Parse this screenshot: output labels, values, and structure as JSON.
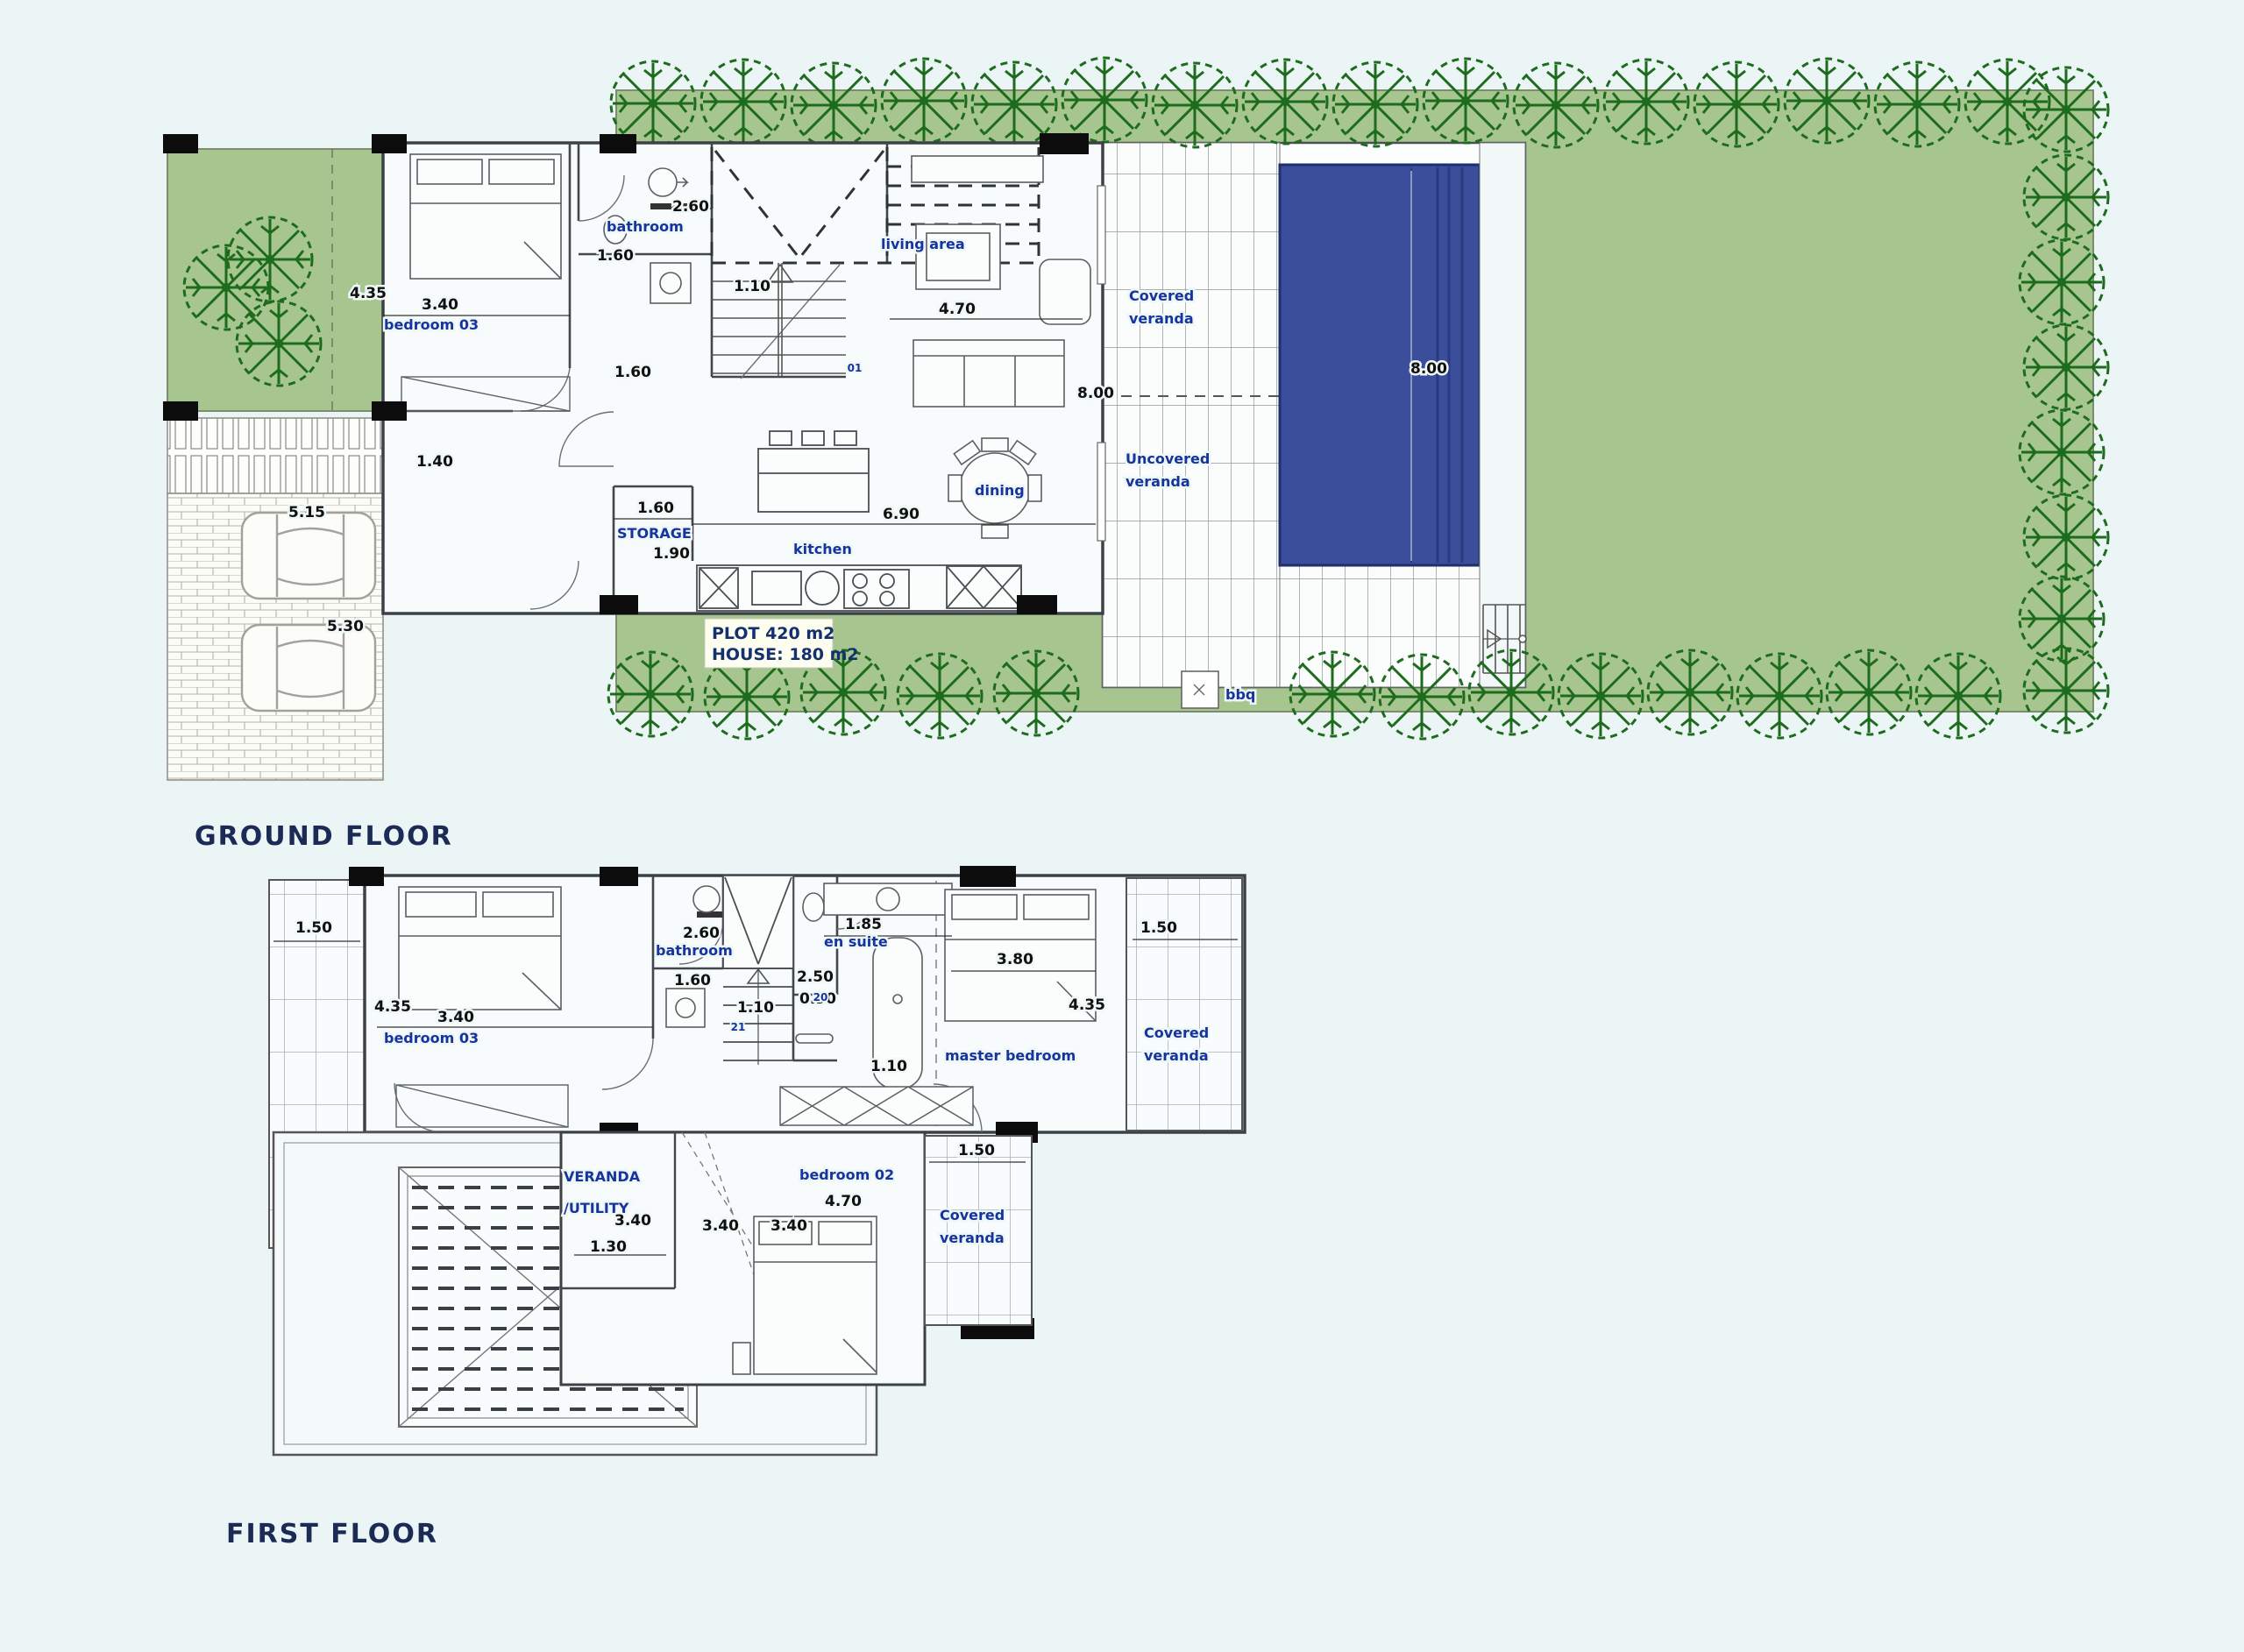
{
  "colors": {
    "background": "#ecf5f5",
    "lawn_green": "#a7c68f",
    "tree_green": "#1d6b1d",
    "pool_blue": "#3b4e9c",
    "wall_dark": "#3c4147",
    "label_blue": "#16349d",
    "title_navy": "#1c2b55"
  },
  "ground_floor": {
    "title": "GROUND FLOOR",
    "rooms": {
      "bedroom03": "bedroom 03",
      "bathroom": "bathroom",
      "living": "living area",
      "dining": "dining",
      "kitchen": "kitchen",
      "storage": "STORAGE",
      "covered1": "Covered",
      "covered2": "veranda",
      "uncovered1": "Uncovered",
      "uncovered2": "veranda",
      "bbq": "bbq"
    },
    "dims": {
      "bath_w": "2.60",
      "bath_d": "1.60",
      "stair_w": "1.10",
      "bed_h": "4.35",
      "bed_w": "3.40",
      "hall": "1.60",
      "entry": "1.40",
      "living_w": "4.70",
      "living_h": "8.00",
      "kitchen_w": "6.90",
      "storage_w": "1.60",
      "storage_h": "1.90",
      "drive1": "5.15",
      "drive2": "5.30",
      "pool_l": "8.00"
    },
    "plot": {
      "l1": "PLOT 420 m2",
      "l2": "HOUSE: 180 m2"
    },
    "stair_door": "01"
  },
  "first_floor": {
    "title": "FIRST FLOOR",
    "rooms": {
      "bedroom03": "bedroom 03",
      "bathroom": "bathroom",
      "ensuite": "en suite",
      "master": "master bedroom",
      "bedroom02": "bedroom 02",
      "veranda_l1": "VERANDA",
      "veranda_l2": "/UTILITY",
      "covered_r1": "Covered",
      "covered_r2": "veranda",
      "covered_b1": "Covered",
      "covered_b2": "veranda"
    },
    "dims": {
      "left_v": "1.50",
      "bath_w": "2.60",
      "bath_d": "1.60",
      "ensuite_w": "1.85",
      "wc_d": "2.50",
      "wc_w": "0.90",
      "stair_w": "1.10",
      "bed3_h": "4.35",
      "bed3_w": "3.40",
      "master_w": "3.80",
      "master_h": "4.35",
      "right_v": "1.50",
      "hall": "1.10",
      "util_w": "3.40",
      "util_d": "1.30",
      "void_w": "3.40",
      "bed2_d": "3.40",
      "bed2_w": "4.70",
      "bottom_v": "1.50"
    },
    "steps": {
      "s20": "20",
      "s21": "21"
    }
  }
}
